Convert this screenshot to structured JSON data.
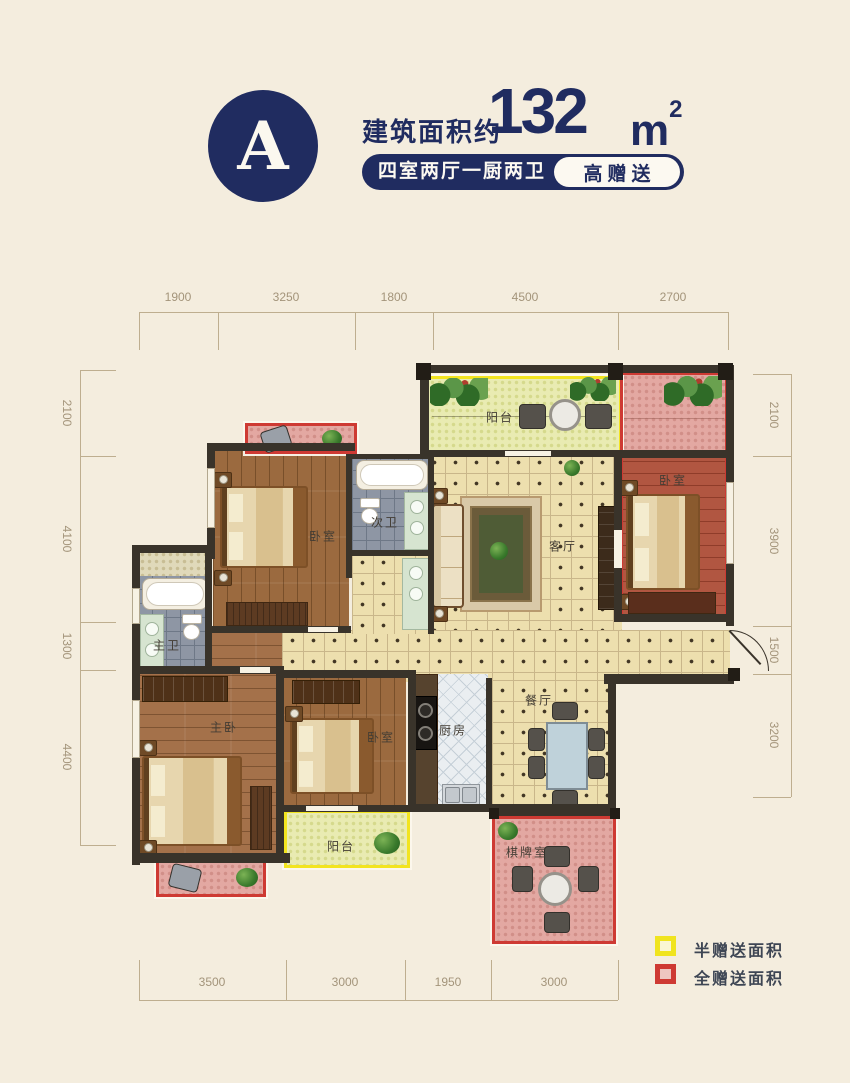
{
  "header": {
    "unit_label": "A",
    "area_prefix": "建筑面积约",
    "area_value": "132",
    "area_unit_base": "m",
    "area_unit_exp": "2",
    "layout_tag": "四室两厅一厨两卫",
    "bonus_tag": "高赠送"
  },
  "dimensions": {
    "top": [
      "1900",
      "3250",
      "1800",
      "4500",
      "2700"
    ],
    "bottom": [
      "3500",
      "3000",
      "1950",
      "3000"
    ],
    "left": [
      "2100",
      "4100",
      "1300",
      "4400"
    ],
    "right": [
      "2100",
      "3900",
      "1500",
      "3200"
    ]
  },
  "rooms": {
    "balcony_top": "阳台",
    "bedroom_right": "卧室",
    "living_room": "客厅",
    "bedroom_top_left": "卧室",
    "second_bath": "次卫",
    "master_bath": "主卫",
    "master_bedroom": "主卧",
    "bedroom_bottom": "卧室",
    "balcony_bottom": "阳台",
    "kitchen": "厨房",
    "dining_room": "餐厅",
    "game_room": "棋牌室"
  },
  "legend": {
    "half_gift": {
      "label": "半赠送面积",
      "color": "#f2e41f"
    },
    "full_gift": {
      "label": "全赠送面积",
      "color": "#ce3a33"
    }
  },
  "colors": {
    "accent_navy": "#202c60",
    "background": "#f4edde",
    "wall": "#39332a",
    "half_gift_border": "#f2e41f",
    "full_gift_border": "#ce3a33"
  }
}
